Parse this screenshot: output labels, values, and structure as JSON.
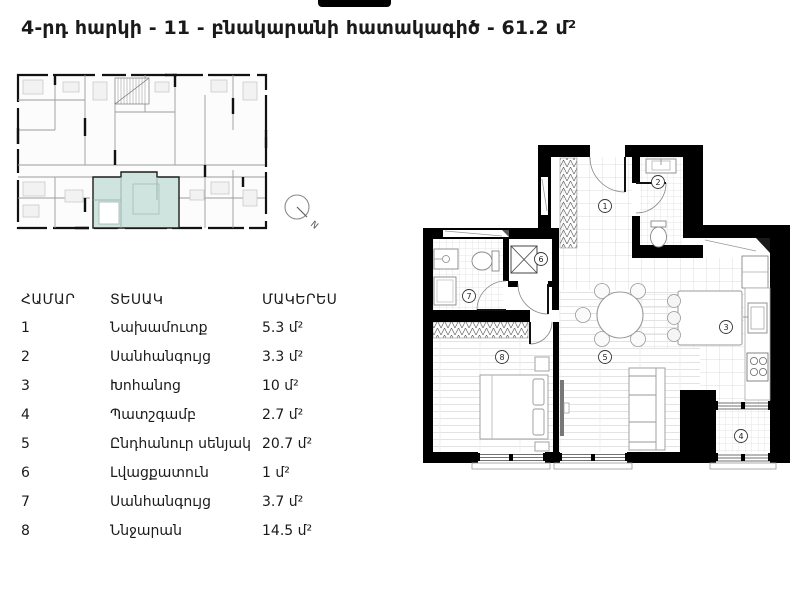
{
  "header": {
    "title": "4-րդ հարկի - 11 - բնակարանի հատակագիծ - 61.2 մ²"
  },
  "overview": {
    "compass_label": "N",
    "highlight_color": "#cfe4de",
    "wall_color": "#000000"
  },
  "rooms_table": {
    "headers": [
      "ՀԱՄԱՐ",
      "ՏԵՍԱԿ",
      "ՄԱԿԵՐԵՍ"
    ],
    "rows": [
      {
        "num": "1",
        "name": "Նախամուտք",
        "area": "5.3 մ²"
      },
      {
        "num": "2",
        "name": "Սանհանգույց",
        "area": "3.3 մ²"
      },
      {
        "num": "3",
        "name": "Խոհանոց",
        "area": "10 մ²"
      },
      {
        "num": "4",
        "name": "Պատշգամբ",
        "area": "2.7 մ²"
      },
      {
        "num": "5",
        "name": "Ընդհանուր սենյակ",
        "area": "20.7 մ²"
      },
      {
        "num": "6",
        "name": "Լվացքատուն",
        "area": "1 մ²"
      },
      {
        "num": "7",
        "name": "Սանհանգույց",
        "area": "3.7 մ²"
      },
      {
        "num": "8",
        "name": "Ննջարան",
        "area": "14.5 մ²"
      }
    ]
  },
  "floor_plan": {
    "room_numbers": [
      "1",
      "2",
      "3",
      "4",
      "5",
      "6",
      "7",
      "8"
    ]
  }
}
